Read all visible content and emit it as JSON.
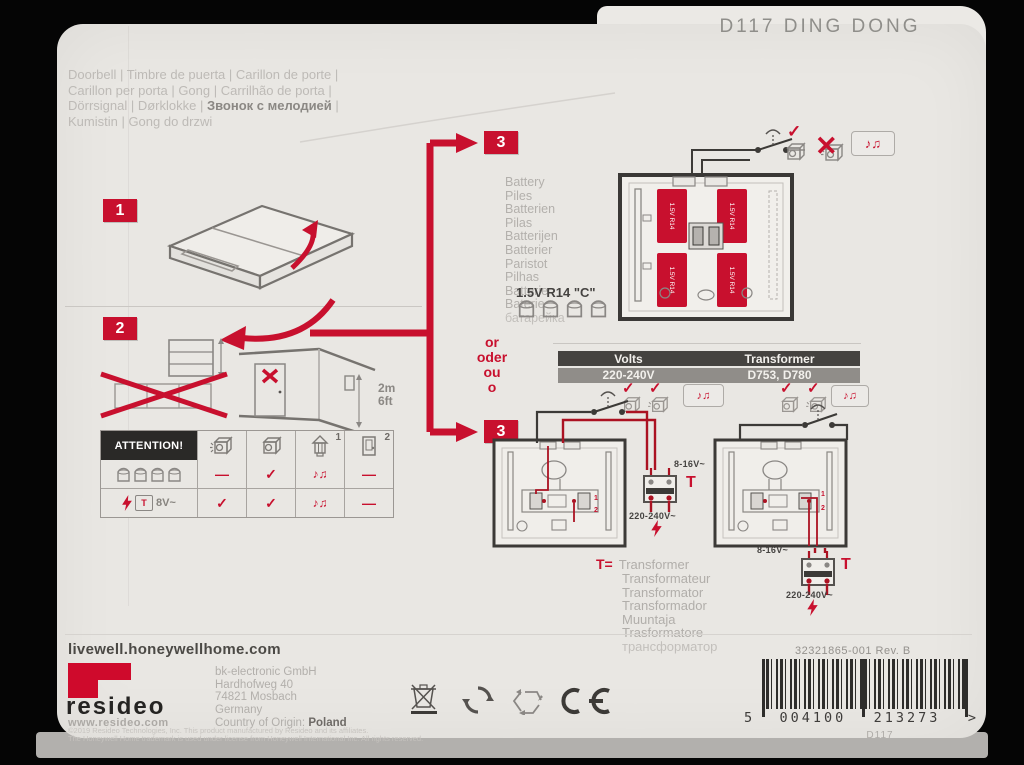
{
  "title": "D117 DING DONG",
  "languages": {
    "line1": "Doorbell | Timbre de puerta | Carillon de porte |",
    "line2": "Carillon per porta | Gong | Carrilhão de porta |",
    "line3_pre": "Dörrsignal | Dørklokke | ",
    "line3_bold": "Звонок с мелодией",
    "line3_post": " |",
    "line4": "Kumistin | Gong do drzwi"
  },
  "steps": {
    "s1": "1",
    "s2": "2",
    "s3": "3"
  },
  "step2": {
    "height_m": "2m",
    "height_ft": "6ft"
  },
  "symbols": {
    "check": "✓",
    "cross": "✕",
    "dash": "—",
    "notes": "♪♫"
  },
  "attention": {
    "title": "ATTENTION!",
    "col3_sup": "1",
    "col4_sup": "2",
    "transformer_label": "8V~",
    "row_battery_marks": [
      "—",
      "✓",
      "♪♫",
      "—"
    ],
    "row_transformer_marks": [
      "✓",
      "✓",
      "♪♫",
      "—"
    ]
  },
  "battery": {
    "words": [
      "Battery",
      "Piles",
      "Batterien",
      "Pilas",
      "Batterijen",
      "Batterier",
      "Paristot",
      "Pilhas",
      "Batterie",
      "Baterie",
      "батарейка"
    ],
    "size_label": "1.5V R14 \"C\"",
    "cell_label": "1.5V R14"
  },
  "or_words": [
    "or",
    "oder",
    "ou",
    "o"
  ],
  "volts_table": {
    "header_volts": "Volts",
    "header_transformer": "Transformer",
    "row_volts": "220-240V",
    "row_transformer": "D753, D780"
  },
  "wiring": {
    "low_voltage": "8-16V~",
    "mains": "220-240V~",
    "transformer_symbol": "T",
    "terminal_1": "1",
    "terminal_2": "2"
  },
  "legend": {
    "prefix": "T=",
    "words": [
      "Transformer",
      "Transformateur",
      "Transformator",
      "Transformador",
      "Muuntaja",
      "Trasformatore",
      "трансформатор"
    ]
  },
  "footer": {
    "url": "livewell.honeywellhome.com",
    "brand": "resideo",
    "brand_site": "www.resideo.com",
    "address": [
      "bk-electronic GmbH",
      "Hardhofweg 40",
      "74821 Mosbach",
      "Germany"
    ],
    "origin_label": "Country of Origin: ",
    "origin_value": "Poland",
    "legal_line1": "©2019 Resideo Technologies, Inc. This product manufactured by Resideo and its affiliates.",
    "legal_line2": "The Honeywell Home trademark is used under license from Honeywell International Inc. All rights reserved.",
    "part_number": "32321865-001 Rev. B",
    "barcode_lead": "5",
    "barcode_group1": "004100",
    "barcode_group2": "213273",
    "barcode_trail": ">",
    "model": "D117"
  }
}
